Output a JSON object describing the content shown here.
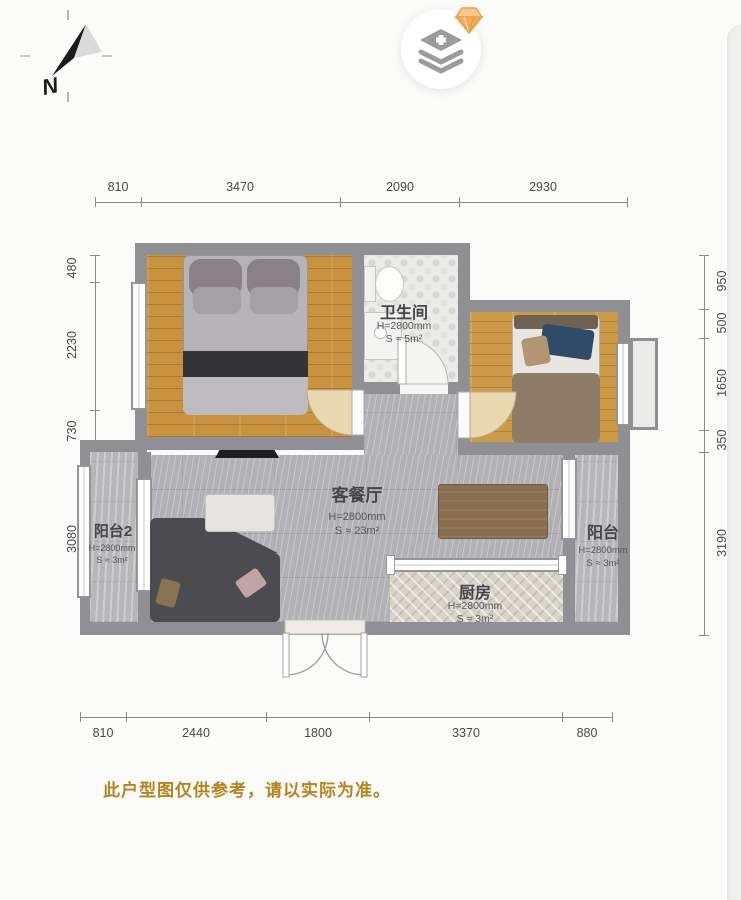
{
  "compass": {
    "north_label": "N"
  },
  "toolbar": {
    "layers_button": {
      "icon": "layers-plus-icon",
      "badge_icon": "gem-badge-icon"
    }
  },
  "dimensions": {
    "top": [
      "810",
      "3470",
      "2090",
      "2930"
    ],
    "bottom": [
      "810",
      "2440",
      "1800",
      "3370",
      "880"
    ],
    "left": [
      "480",
      "2230",
      "730",
      "3080"
    ],
    "right": [
      "950",
      "500",
      "1650",
      "350",
      "3190"
    ]
  },
  "rooms": {
    "bathroom": {
      "name": "卫生间",
      "height": "H=2800mm",
      "area": "S ≈ 5m²"
    },
    "living": {
      "name": "客餐厅",
      "height": "H=2800mm",
      "area": "S ≈ 23m²"
    },
    "balcony2": {
      "name": "阳台2",
      "height": "H=2800mm",
      "area": "S ≈ 3m²"
    },
    "balcony": {
      "name": "阳台",
      "height": "H=2800mm",
      "area": "S ≈ 3m²"
    },
    "kitchen": {
      "name": "厨房",
      "height": "H=2800mm",
      "area": "S ≈ 3m²"
    }
  },
  "disclaimer": "此户型图仅供参考，请以实际为准。",
  "colors": {
    "wall": "#909094",
    "wood_floor": "#c8923f",
    "tile_floor": "#b2b2b6",
    "accent_text": "#b6831d",
    "gem_badge": "#f0a24b",
    "icon_gray": "#9b9b9b"
  }
}
